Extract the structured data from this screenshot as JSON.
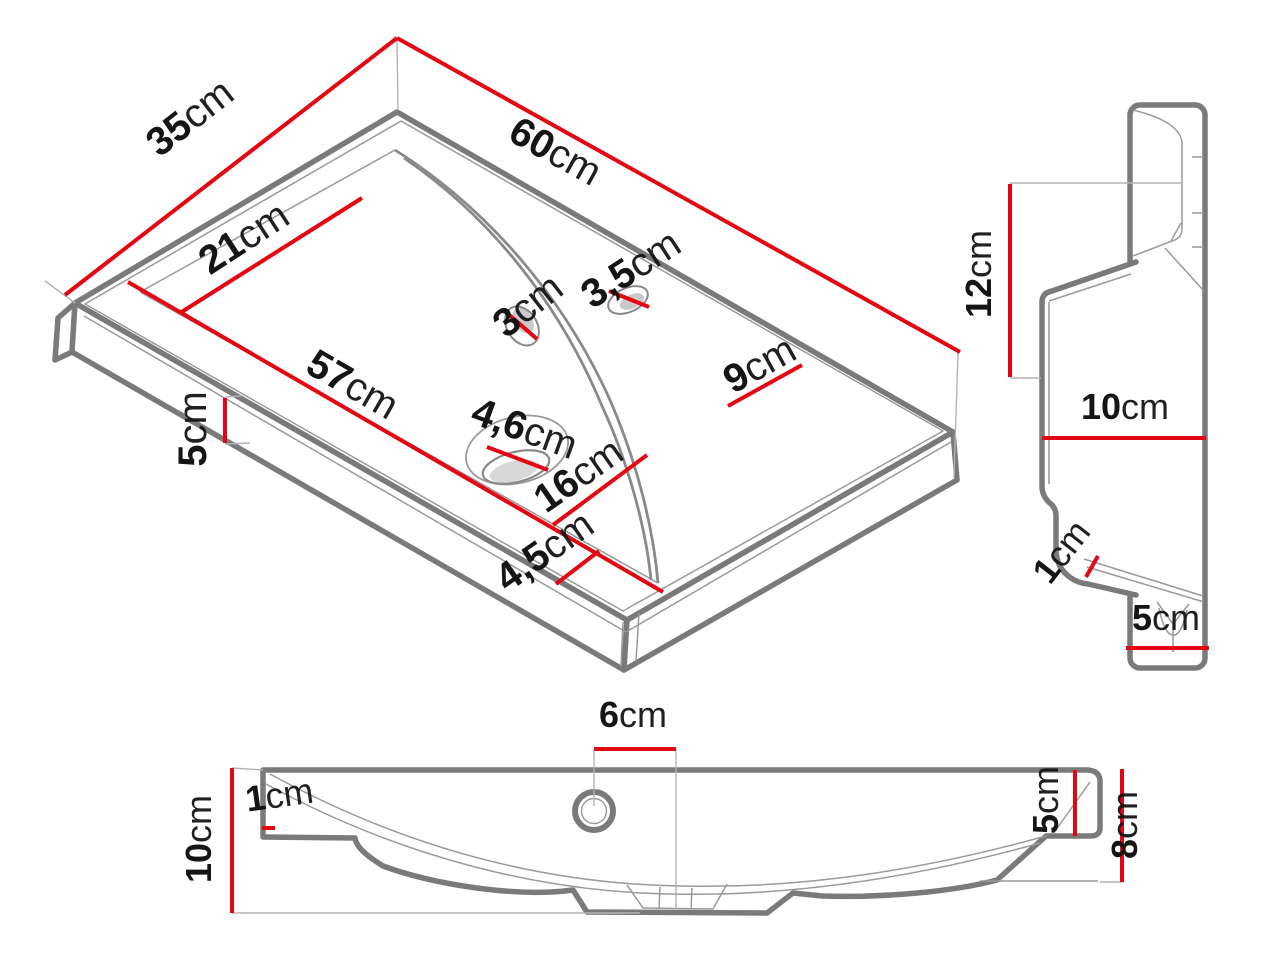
{
  "drawing": {
    "title": "Washbasin technical dimension drawing",
    "unit": "cm",
    "colors": {
      "dimension_line": "#e30613",
      "outline": "#7a7a7a",
      "thin_line": "#9a9a9a",
      "label_text": "#151515",
      "background": "#ffffff"
    },
    "views": {
      "isometric_top": {
        "name": "isometric top view",
        "dims": {
          "d35": {
            "num": "35",
            "unit": "cm"
          },
          "d60": {
            "num": "60",
            "unit": "cm"
          },
          "d21": {
            "num": "21",
            "unit": "cm"
          },
          "d57": {
            "num": "57",
            "unit": "cm"
          },
          "d5": {
            "num": "5",
            "unit": "cm"
          },
          "d3": {
            "num": "3",
            "unit": "cm"
          },
          "d3_5": {
            "num": "3,5",
            "unit": "cm"
          },
          "d9": {
            "num": "9",
            "unit": "cm"
          },
          "d4_6": {
            "num": "4,6",
            "unit": "cm"
          },
          "d16": {
            "num": "16",
            "unit": "cm"
          },
          "d4_5": {
            "num": "4,5",
            "unit": "cm"
          }
        }
      },
      "side_profile": {
        "name": "side profile view",
        "dims": {
          "d12": {
            "num": "12",
            "unit": "cm"
          },
          "d10": {
            "num": "10",
            "unit": "cm"
          },
          "d1": {
            "num": "1",
            "unit": "cm"
          },
          "d5": {
            "num": "5",
            "unit": "cm"
          }
        }
      },
      "front_elevation": {
        "name": "front elevation view",
        "dims": {
          "d10": {
            "num": "10",
            "unit": "cm"
          },
          "d1": {
            "num": "1",
            "unit": "cm"
          },
          "d6": {
            "num": "6",
            "unit": "cm"
          },
          "d5": {
            "num": "5",
            "unit": "cm"
          },
          "d8": {
            "num": "8",
            "unit": "cm"
          }
        }
      }
    }
  }
}
